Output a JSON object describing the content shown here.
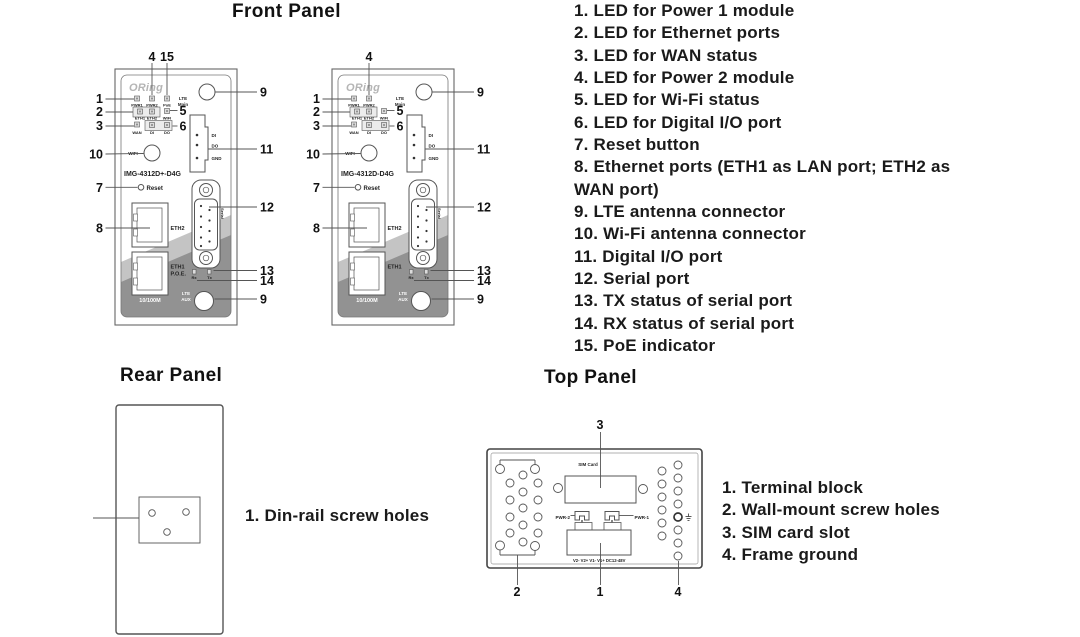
{
  "front_panel": {
    "title": "Front Panel",
    "legend": [
      "1. LED for Power 1 module",
      "2. LED for Ethernet ports",
      "3. LED for WAN status",
      "4. LED for Power 2 module",
      "5. LED for Wi-Fi status",
      "6. LED for Digital I/O port",
      "7. Reset button",
      "8. Ethernet ports (ETH1 as LAN port; ETH2 as\nWAN port)",
      "9. LTE antenna connector",
      "10. Wi-Fi antenna connector",
      "11. Digital I/O port",
      "12. Serial port",
      "13. TX status of serial port",
      "14. RX status of serial port",
      "15. PoE indicator"
    ],
    "callouts": {
      "pwr1": "1",
      "eth": "2",
      "wan": "3",
      "pwr2": "4",
      "poe": "15",
      "wifi_status": "5",
      "dio_led": "6",
      "reset": "7",
      "eth_ports": "8",
      "lte_main": "9",
      "wifi_ant": "10",
      "dio_port": "11",
      "serial": "12",
      "tx": "13",
      "rx": "14",
      "lte_aux": "9"
    },
    "devices": [
      {
        "logo": "ORing",
        "model": "IMG-4312D+-D4G",
        "has_poe": true,
        "lte_main_1": "LTE",
        "lte_main_2": "Main",
        "lte_aux_1": "LTE",
        "lte_aux_2": "AUX",
        "wifi_antenna": "WIFI",
        "reset": "Reset",
        "pwr1": "PWR1",
        "pwr2": "PWR2",
        "poe": "PoE",
        "eth1_led": "ETH1",
        "eth2_led": "ETH2",
        "wifi_led": "WIFI",
        "wan_led": "WAN",
        "di_led": "DI",
        "do_led": "DO",
        "dio_di": "DI",
        "dio_do": "DO",
        "dio_gnd": "GND",
        "eth2": "ETH2",
        "eth1": "ETH1",
        "eth1_sub": "P.O.E.",
        "speed": "10/100M",
        "serial": "Serial",
        "rx": "Rx",
        "tx": "Tx"
      },
      {
        "logo": "ORing",
        "model": "IMG-4312D-D4G",
        "has_poe": false,
        "lte_main_1": "LTE",
        "lte_main_2": "Main",
        "lte_aux_1": "LTE",
        "lte_aux_2": "AUX",
        "wifi_antenna": "WIFI",
        "reset": "Reset",
        "pwr1": "PWR1",
        "pwr2": "PWR2",
        "poe": "",
        "eth1_led": "ETH1",
        "eth2_led": "ETH2",
        "wifi_led": "WIFI",
        "wan_led": "WAN",
        "di_led": "DI",
        "do_led": "DO",
        "dio_di": "DI",
        "dio_do": "DO",
        "dio_gnd": "GND",
        "eth2": "ETH2",
        "eth1": "ETH1",
        "eth1_sub": "",
        "speed": "10/100M",
        "serial": "Serial",
        "rx": "Rx",
        "tx": "Tx"
      }
    ]
  },
  "rear_panel": {
    "title": "Rear Panel",
    "legend": [
      "1. Din-rail screw holes"
    ]
  },
  "top_panel": {
    "title": "Top Panel",
    "sim_card": "SIM Card",
    "pwr_2": "PWR-2",
    "pwr_1": "PWR-1",
    "terminals": "V2-   V2+  V1-   V1+     DC12-48V",
    "callouts": {
      "terminal": "1",
      "wall": "2",
      "sim": "3",
      "ground": "4"
    },
    "legend": [
      "1. Terminal block",
      "2. Wall-mount screw holes",
      "3. SIM card slot",
      "4. Frame ground"
    ]
  }
}
